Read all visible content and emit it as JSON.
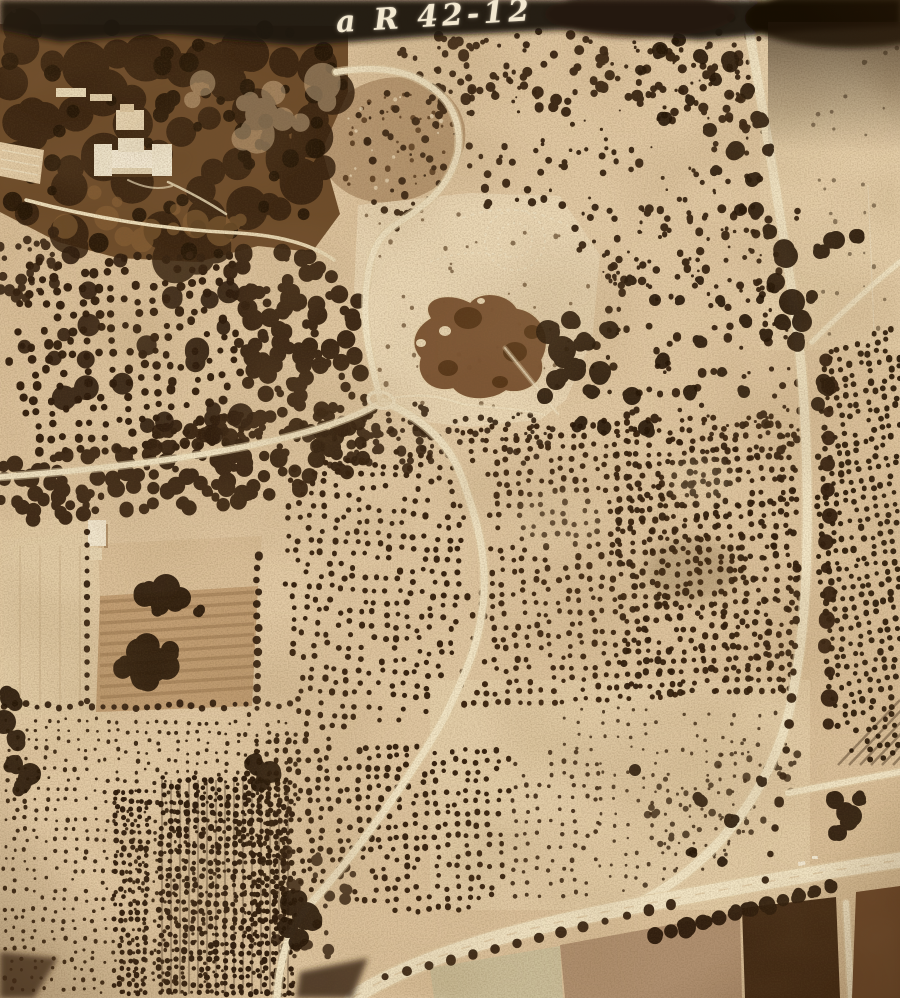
{
  "photo": {
    "annotation_text": "a R 42-12",
    "palette": {
      "paper_light": "#ecd9b3",
      "paper_tan": "#dcc099",
      "paper_dark_tan": "#c9a87e",
      "tree_dark": "#321f0e",
      "tree_deep": "#241506",
      "road_light": "#f3e6c6",
      "road_shoulder": "#e8d5ae",
      "pond_brown": "#7a5230",
      "estate_dark": "#6e4b29",
      "field_dark_plot": "#3f2712",
      "exposure_band": "#1f1309"
    }
  }
}
